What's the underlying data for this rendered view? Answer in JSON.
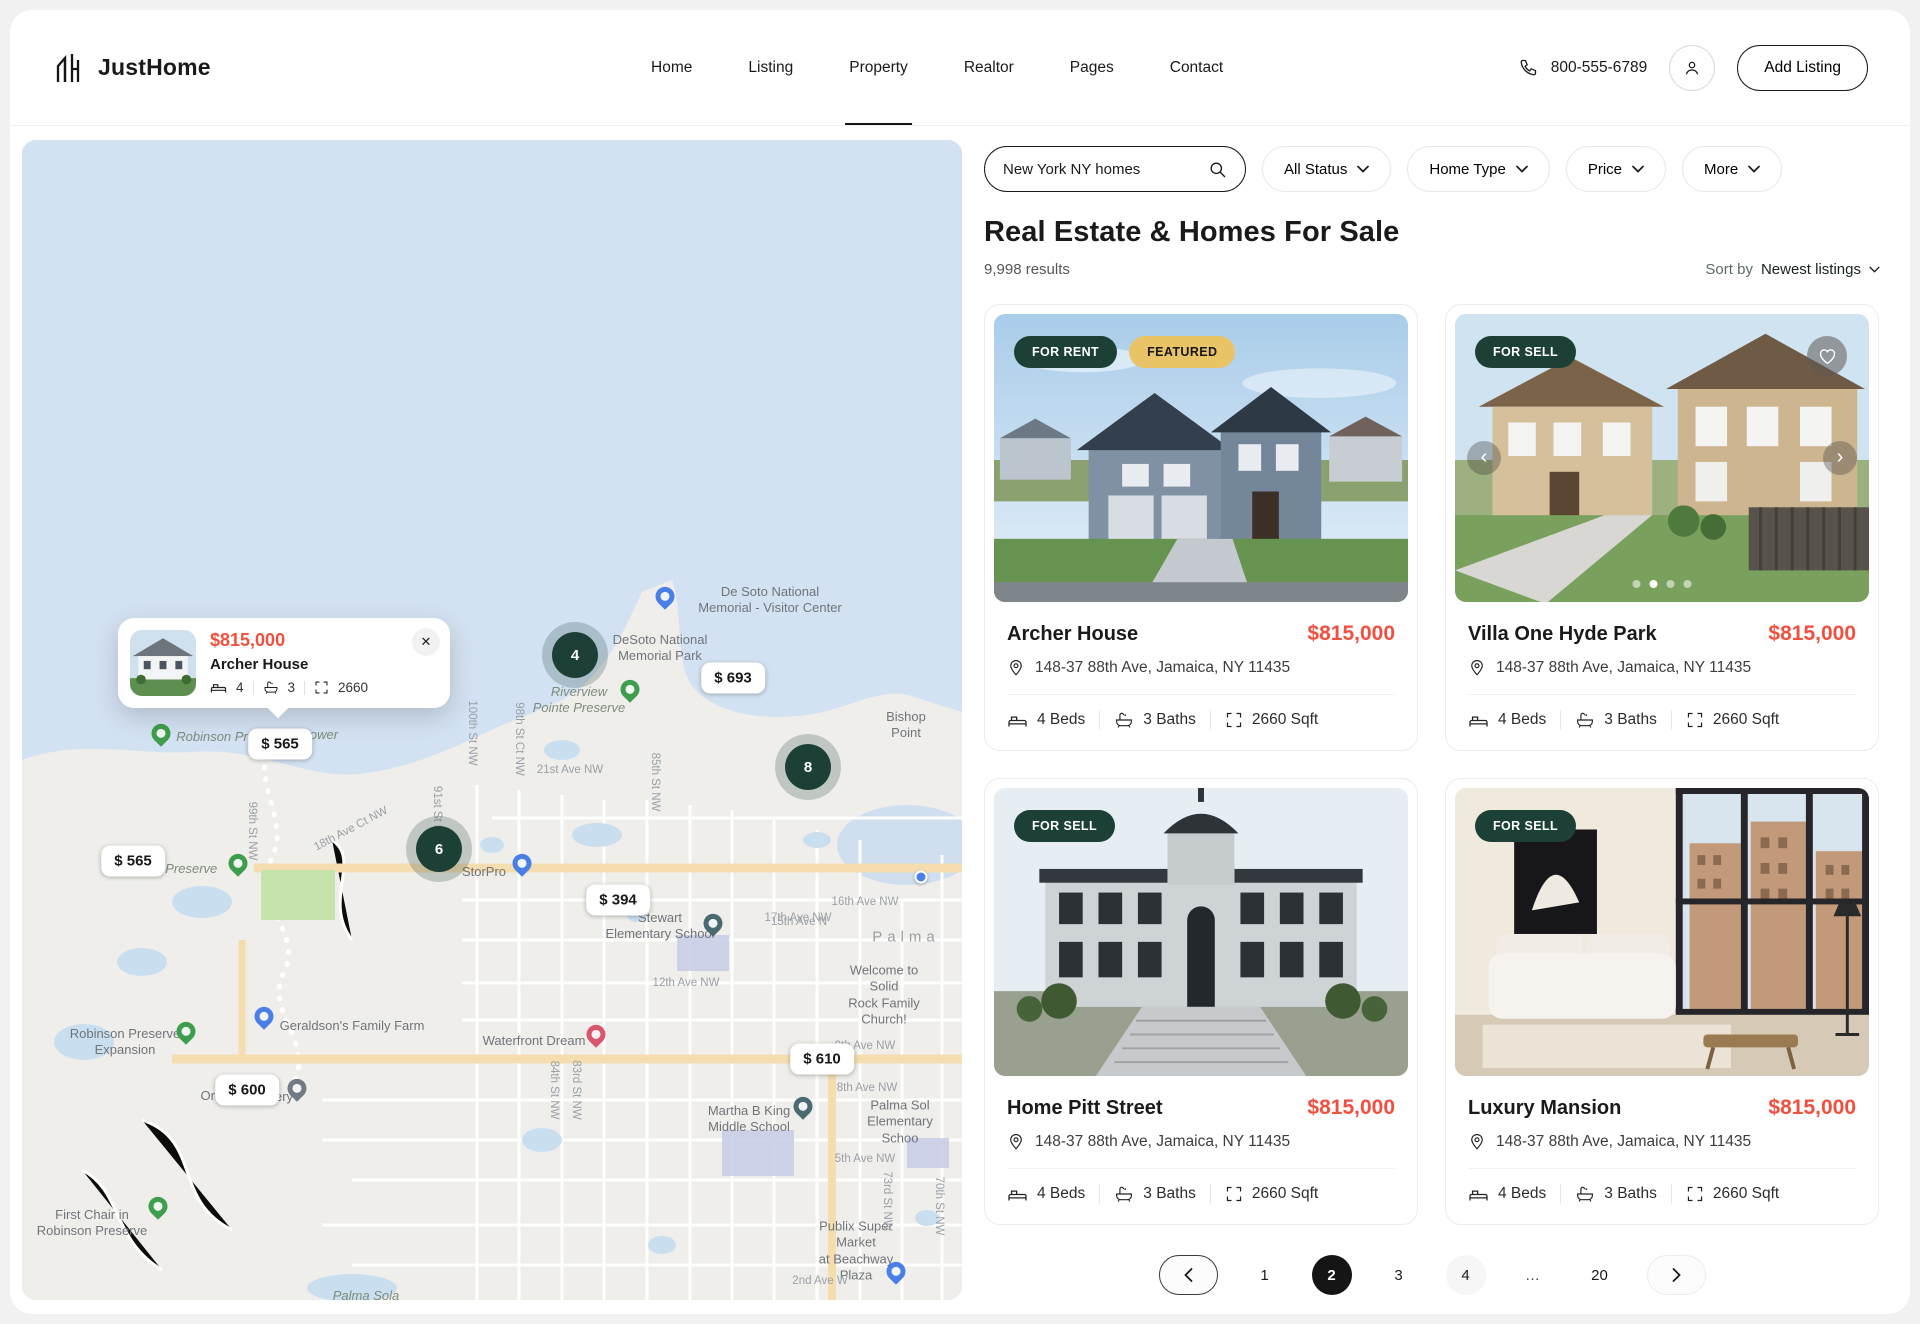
{
  "colors": {
    "accent_red": "#f2503f",
    "badge_green": "#1d4036",
    "badge_gold": "#e9c467",
    "water": "#d3e2f2",
    "land": "#efeeeb"
  },
  "header": {
    "brand": "JustHome",
    "nav": [
      {
        "label": "Home"
      },
      {
        "label": "Listing"
      },
      {
        "label": "Property"
      },
      {
        "label": "Realtor"
      },
      {
        "label": "Pages"
      },
      {
        "label": "Contact"
      }
    ],
    "phone": "800-555-6789",
    "add_listing_label": "Add Listing"
  },
  "filters": {
    "search_value": "New York NY homes",
    "status_label": "All Status",
    "home_type_label": "Home Type",
    "price_label": "Price",
    "more_label": "More"
  },
  "results": {
    "title": "Real Estate & Homes For Sale",
    "count": "9,998 results",
    "sort_label": "Sort by",
    "sort_value": "Newest listings"
  },
  "cards": [
    {
      "badge1": "FOR RENT",
      "badge2": "FEATURED",
      "name": "Archer House",
      "price": "$815,000",
      "address": "148-37 88th Ave, Jamaica, NY 11435",
      "beds": "4 Beds",
      "baths": "3 Baths",
      "sqft": "2660 Sqft"
    },
    {
      "badge1": "FOR SELL",
      "name": "Villa One Hyde Park",
      "price": "$815,000",
      "address": "148-37 88th Ave, Jamaica, NY 11435",
      "beds": "4 Beds",
      "baths": "3 Baths",
      "sqft": "2660 Sqft"
    },
    {
      "badge1": "FOR SELL",
      "name": "Home Pitt Street",
      "price": "$815,000",
      "address": "148-37 88th Ave, Jamaica, NY 11435",
      "beds": "4 Beds",
      "baths": "3 Baths",
      "sqft": "2660 Sqft"
    },
    {
      "badge1": "FOR SELL",
      "name": "Luxury Mansion",
      "price": "$815,000",
      "address": "148-37 88th Ave, Jamaica, NY 11435",
      "beds": "4 Beds",
      "baths": "3 Baths",
      "sqft": "2660 Sqft"
    }
  ],
  "pagination": {
    "pages": [
      "1",
      "2",
      "3",
      "4",
      "…",
      "20"
    ],
    "active_page": "2"
  },
  "map": {
    "popup": {
      "price": "$815,000",
      "title": "Archer House",
      "beds": "4",
      "baths": "3",
      "sqft": "2660",
      "close": "✕"
    },
    "items": [
      {
        "type": "price",
        "text": "$ 693",
        "x": 711,
        "y": 538
      },
      {
        "type": "price",
        "text": "$ 565",
        "x": 258,
        "y": 604
      },
      {
        "type": "price",
        "text": "$ 565",
        "x": 111,
        "y": 721
      },
      {
        "type": "price",
        "text": "$ 394",
        "x": 596,
        "y": 760
      },
      {
        "type": "price",
        "text": "$ 610",
        "x": 800,
        "y": 919
      },
      {
        "type": "price",
        "text": "$ 600",
        "x": 225,
        "y": 950
      },
      {
        "type": "cluster",
        "text": "4",
        "x": 553,
        "y": 515
      },
      {
        "type": "cluster",
        "text": "8",
        "x": 786,
        "y": 627
      },
      {
        "type": "cluster",
        "text": "6",
        "x": 417,
        "y": 709
      },
      {
        "type": "pin",
        "pin": "blue",
        "x": 643,
        "y": 463,
        "name": "visitor-center-pin"
      },
      {
        "type": "pin",
        "pin": "green",
        "x": 608,
        "y": 556,
        "name": "park-pin"
      },
      {
        "type": "pin",
        "pin": "green",
        "x": 139,
        "y": 600,
        "name": "park-pin"
      },
      {
        "type": "pin",
        "pin": "green",
        "x": 216,
        "y": 730,
        "name": "park-pin"
      },
      {
        "type": "pin",
        "pin": "green",
        "x": 164,
        "y": 898,
        "name": "park-pin"
      },
      {
        "type": "pin",
        "pin": "green",
        "x": 136,
        "y": 1073,
        "name": "park-pin"
      },
      {
        "type": "pin",
        "pin": "blue",
        "x": 500,
        "y": 730,
        "name": "storpro-pin"
      },
      {
        "type": "pin",
        "pin": "blue",
        "x": 242,
        "y": 883,
        "name": "farm-pin"
      },
      {
        "type": "pin",
        "pin": "blue",
        "x": 874,
        "y": 1138,
        "name": "publix-pin"
      },
      {
        "type": "pin",
        "pin": "teal",
        "x": 691,
        "y": 790,
        "name": "school-pin"
      },
      {
        "type": "pin",
        "pin": "teal",
        "x": 781,
        "y": 973,
        "name": "school-pin"
      },
      {
        "type": "pin",
        "pin": "pink",
        "x": 574,
        "y": 901,
        "name": "lodging-pin"
      },
      {
        "type": "pin",
        "pin": "gray",
        "x": 275,
        "y": 955,
        "name": "poi-pin"
      },
      {
        "type": "dot",
        "x": 899,
        "y": 737,
        "name": "location-dot"
      },
      {
        "type": "label",
        "text": "De Soto National\nMemorial - Visitor Center",
        "x": 748,
        "y": 460
      },
      {
        "type": "label",
        "text": "DeSoto National\nMemorial Park",
        "x": 638,
        "y": 508
      },
      {
        "type": "label-i",
        "text": "Riverview\nPointe Preserve",
        "x": 557,
        "y": 560
      },
      {
        "type": "label",
        "text": "Bishop Point",
        "x": 884,
        "y": 585
      },
      {
        "type": "label-i",
        "text": "Robinson Pr",
        "x": 190,
        "y": 597
      },
      {
        "type": "label-i",
        "text": "ower",
        "x": 302,
        "y": 595
      },
      {
        "type": "label-i",
        "text": "Robinson Preserve",
        "x": 140,
        "y": 729
      },
      {
        "type": "label",
        "text": "StorPro",
        "x": 462,
        "y": 732
      },
      {
        "type": "label",
        "text": "Stewart\nElementary School",
        "x": 638,
        "y": 786
      },
      {
        "type": "city",
        "text": "Palma",
        "x": 884,
        "y": 797
      },
      {
        "type": "label",
        "text": "Welcome to Solid\nRock Family Church!",
        "x": 862,
        "y": 855
      },
      {
        "type": "label",
        "text": "Geraldson's Family Farm",
        "x": 330,
        "y": 886
      },
      {
        "type": "label",
        "text": "Waterfront Dream",
        "x": 512,
        "y": 901
      },
      {
        "type": "label",
        "text": "Robinson Preserve\nExpansion",
        "x": 103,
        "y": 902
      },
      {
        "type": "label",
        "text": "Orba",
        "x": 193,
        "y": 956
      },
      {
        "type": "label",
        "text": "ery",
        "x": 262,
        "y": 957
      },
      {
        "type": "label",
        "text": "Martha B King\nMiddle School",
        "x": 727,
        "y": 979
      },
      {
        "type": "label",
        "text": "Palma Sol\nElementary Schoo",
        "x": 878,
        "y": 982
      },
      {
        "type": "label",
        "text": "Publix Super Market\nat Beachway Plaza",
        "x": 834,
        "y": 1111
      },
      {
        "type": "label",
        "text": "First Chair in\nRobinson Preserve",
        "x": 70,
        "y": 1083
      },
      {
        "type": "label-i",
        "text": "Palma Sola",
        "x": 344,
        "y": 1156
      },
      {
        "type": "street",
        "text": "21st Ave NW",
        "x": 548,
        "y": 630
      },
      {
        "type": "street",
        "text": "17th Ave NW",
        "x": 776,
        "y": 778
      },
      {
        "type": "street",
        "text": "16th Ave NW",
        "x": 843,
        "y": 762
      },
      {
        "type": "street",
        "text": "12th Ave NW",
        "x": 664,
        "y": 843
      },
      {
        "type": "street",
        "text": "9th Ave NW",
        "x": 843,
        "y": 906
      },
      {
        "type": "street",
        "text": "8th Ave NW",
        "x": 845,
        "y": 948
      },
      {
        "type": "street",
        "text": "5th Ave NW",
        "x": 843,
        "y": 1019
      },
      {
        "type": "street",
        "text": "2nd Ave W",
        "x": 798,
        "y": 1141
      },
      {
        "type": "street",
        "text": "15th Ave N",
        "x": 777,
        "y": 782
      },
      {
        "type": "street",
        "text": "100th St NW",
        "x": 450,
        "y": 593,
        "rot": 90
      },
      {
        "type": "street",
        "text": "98th St Ct NW",
        "x": 497,
        "y": 599,
        "rot": 90
      },
      {
        "type": "street",
        "text": "99th St NW",
        "x": 230,
        "y": 691,
        "rot": 90
      },
      {
        "type": "street",
        "text": "91st St NW",
        "x": 415,
        "y": 675,
        "rot": 90
      },
      {
        "type": "street",
        "text": "85th St NW",
        "x": 633,
        "y": 642,
        "rot": 90
      },
      {
        "type": "street",
        "text": "84th St NW",
        "x": 532,
        "y": 950,
        "rot": 90
      },
      {
        "type": "street",
        "text": "83rd St NW",
        "x": 554,
        "y": 950,
        "rot": 90
      },
      {
        "type": "street",
        "text": "73rd St NW",
        "x": 865,
        "y": 1061,
        "rot": 90
      },
      {
        "type": "street",
        "text": "70th St NW",
        "x": 917,
        "y": 1066,
        "rot": 90
      },
      {
        "type": "street",
        "text": "18th Ave Ct NW",
        "x": 329,
        "y": 689,
        "rot": -28
      }
    ]
  }
}
